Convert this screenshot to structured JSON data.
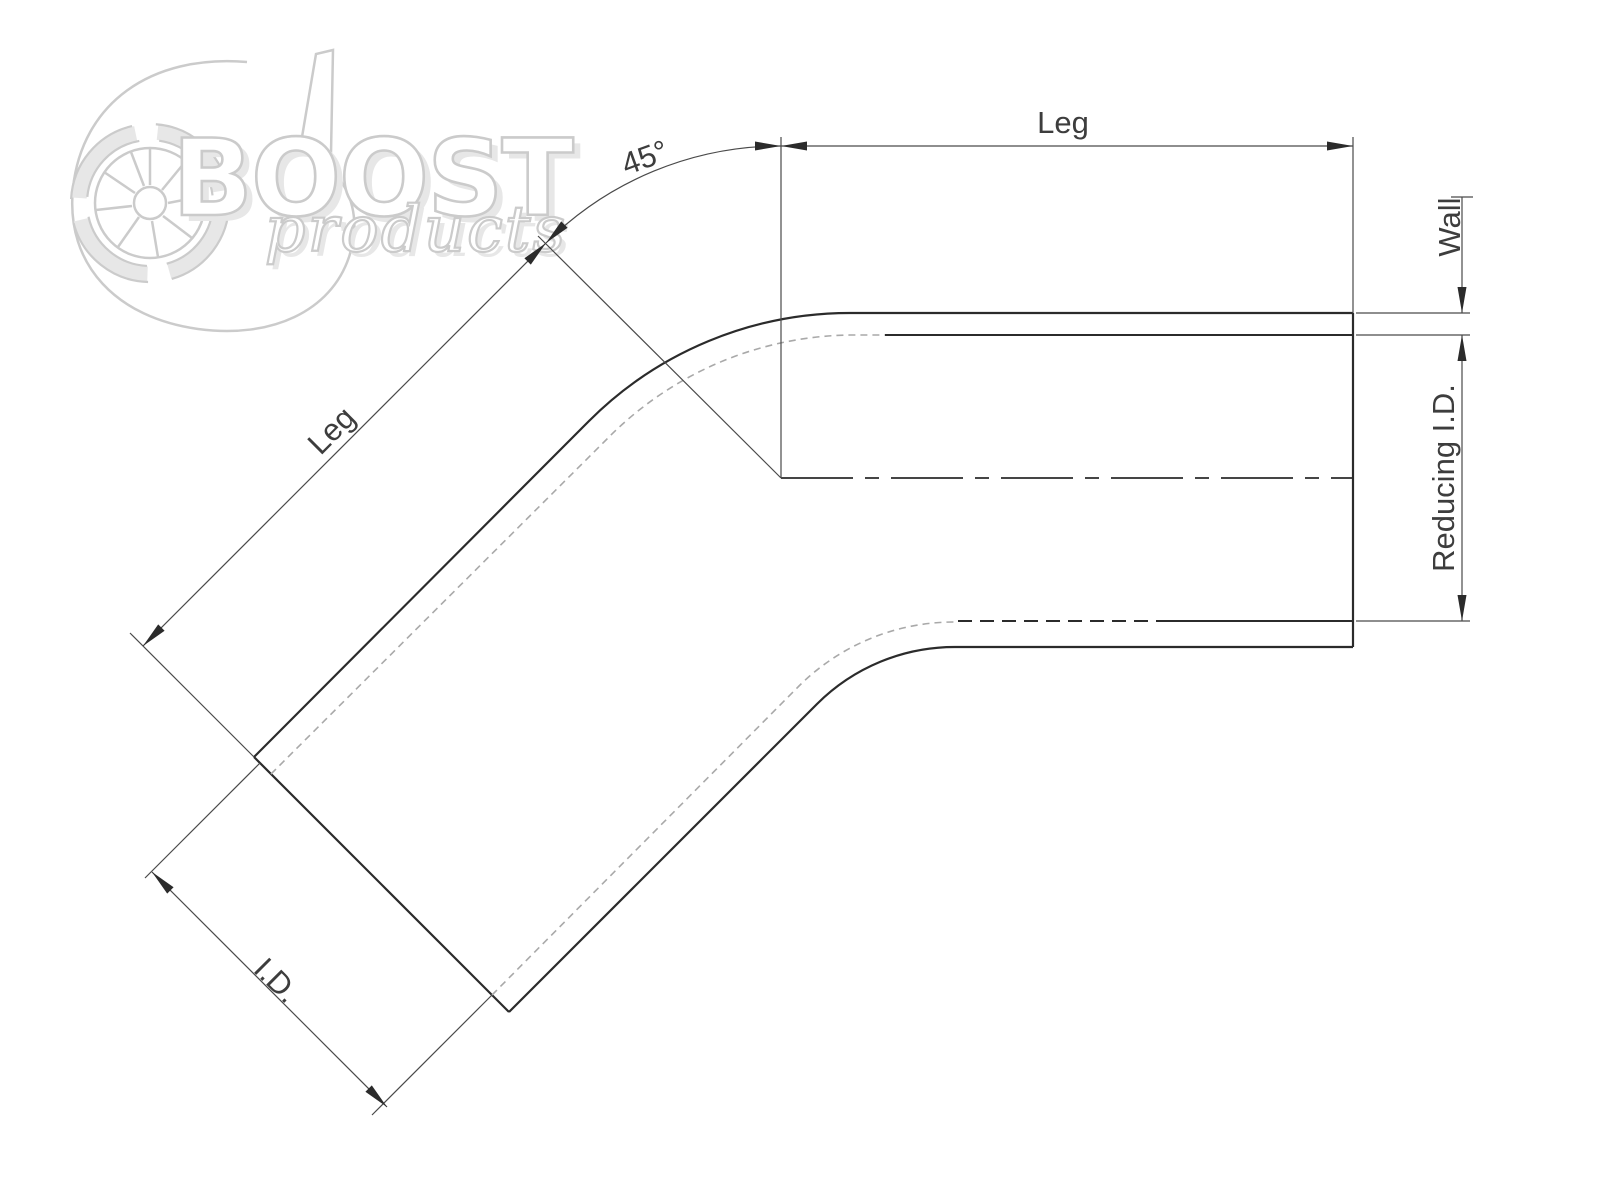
{
  "logo": {
    "brand": "BOOST",
    "sub": "products"
  },
  "labels": {
    "angle": "45°",
    "leg_top": "Leg",
    "leg_diagonal": "Leg",
    "wall": "Wall",
    "reducing_id": "Reducing I.D.",
    "id": "I.D."
  },
  "colors": {
    "ink": "#2b2b2b",
    "dim_line": "#4a4a4a",
    "hidden_line": "#a9a9a9",
    "label_text": "#3d3d3d",
    "logo_gray": "#cbcbcb",
    "logo_shadow": "#e7e7e7",
    "background": "#ffffff"
  }
}
